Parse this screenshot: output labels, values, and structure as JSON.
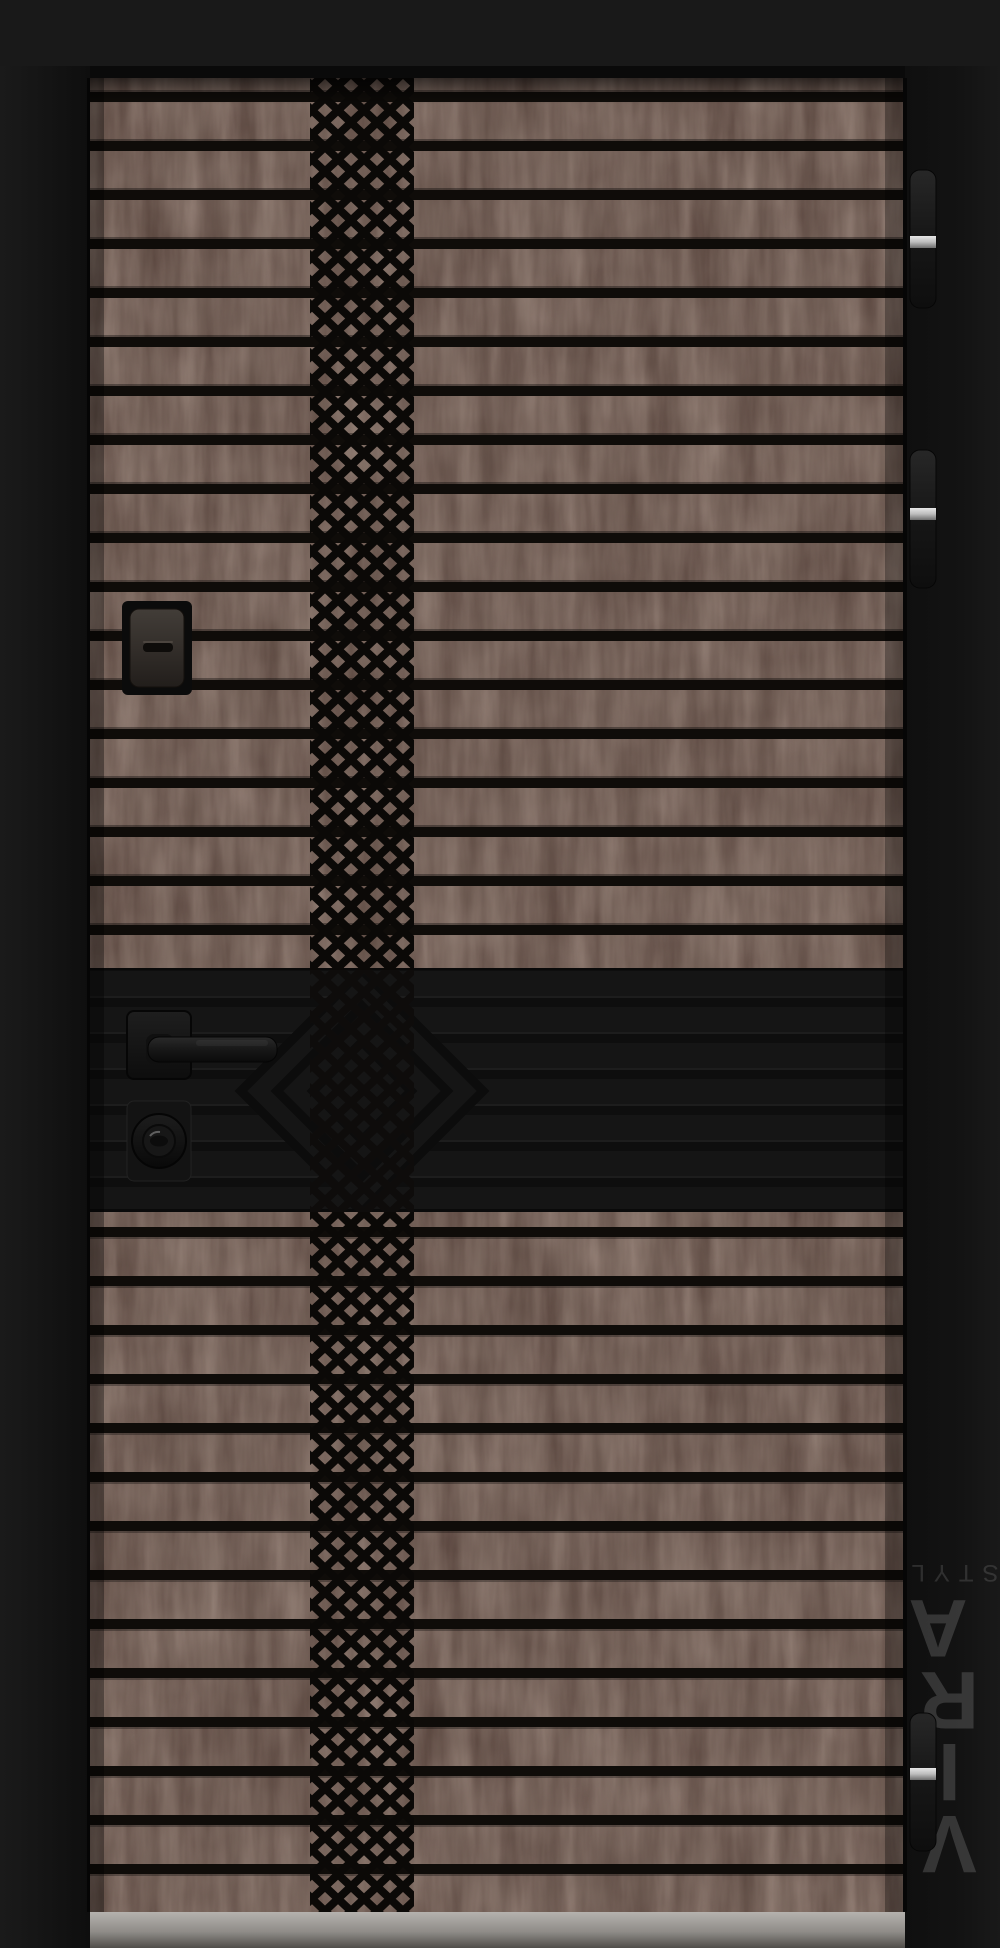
{
  "image": {
    "type": "product-photo",
    "subject": "modern entrance door, dark wood finish with horizontal slats and central diamond lattice milling"
  },
  "watermark": {
    "letters": [
      "V",
      "I",
      "R",
      "A"
    ],
    "sub": "STYLE",
    "color": "#9a9a9a"
  },
  "door": {
    "finish_colors": {
      "wood_base": "#57433c",
      "wood_streak": "#c9a68f",
      "groove_black": "#0f0c09",
      "middle_band": "#151515",
      "frame": "#141414",
      "top_wall": "#191919",
      "threshold_grey": "#a9a6a2",
      "hinge_metal": "#d8d8d8"
    },
    "hardware": {
      "peephole": "peephole-cover",
      "handle": "lever-handle",
      "lock": "cylinder-lock",
      "hinges": [
        "hinge-top",
        "hinge-upper",
        "hinge-bottom"
      ]
    }
  }
}
